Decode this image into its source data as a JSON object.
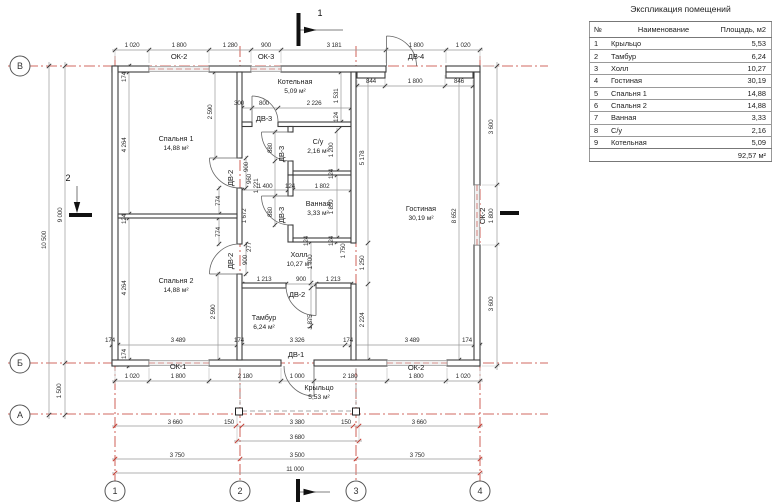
{
  "table": {
    "title": "Экспликация помещений",
    "headers": [
      "№",
      "Наименование",
      "Площадь, м2"
    ],
    "rows": [
      [
        "1",
        "Крыльцо",
        "5,53"
      ],
      [
        "2",
        "Тамбур",
        "6,24"
      ],
      [
        "3",
        "Холл",
        "10,27"
      ],
      [
        "4",
        "Гостиная",
        "30,19"
      ],
      [
        "5",
        "Спальня 1",
        "14,88"
      ],
      [
        "6",
        "Спальня 2",
        "14,88"
      ],
      [
        "7",
        "Ванная",
        "3,33"
      ],
      [
        "8",
        "С/у",
        "2,16"
      ],
      [
        "9",
        "Котельная",
        "5,09"
      ]
    ],
    "total": "92,57 м²"
  },
  "plan": {
    "rooms": [
      {
        "name": "Котельная",
        "area": "5,09 м²",
        "x": 295,
        "y": 84
      },
      {
        "name": "С/у",
        "area": "2,16 м²",
        "x": 318,
        "y": 144
      },
      {
        "name": "Ванная",
        "area": "3,33 м²",
        "x": 318,
        "y": 206
      },
      {
        "name": "Спальня 1",
        "area": "14,88 м²",
        "x": 176,
        "y": 141
      },
      {
        "name": "Спальня 2",
        "area": "14,88 м²",
        "x": 176,
        "y": 283
      },
      {
        "name": "Холл",
        "area": "10,27 м²",
        "x": 299,
        "y": 257
      },
      {
        "name": "Тамбур",
        "area": "6,24 м²",
        "x": 264,
        "y": 320
      },
      {
        "name": "Гостиная",
        "area": "30,19 м²",
        "x": 421,
        "y": 211
      },
      {
        "name": "Крыльцо",
        "area": "5,53 м²",
        "x": 319,
        "y": 390
      }
    ],
    "openings": [
      [
        "ОК-2",
        179,
        59,
        0
      ],
      [
        "ОК-3",
        266,
        59,
        0
      ],
      [
        "ДВ-4",
        416,
        59,
        0
      ],
      [
        "ДВ-3",
        264,
        121,
        0
      ],
      [
        "ДВ-3",
        284,
        154,
        1
      ],
      [
        "ДВ-3",
        284,
        215,
        1
      ],
      [
        "ДВ-2",
        233,
        178,
        1
      ],
      [
        "ДВ-2",
        233,
        261,
        1
      ],
      [
        "ДВ-2",
        297,
        297,
        0
      ],
      [
        "ДВ-1",
        296,
        357,
        0
      ],
      [
        "ОК-1",
        178,
        369,
        0
      ],
      [
        "ОК-2",
        416,
        370,
        0
      ],
      [
        "ОК-2",
        485,
        216,
        1
      ]
    ],
    "dims": [
      [
        "1 020",
        132,
        47,
        0
      ],
      [
        "1 800",
        179,
        47,
        0
      ],
      [
        "1 280",
        230,
        47,
        0
      ],
      [
        "900",
        266,
        47,
        0
      ],
      [
        "3 181",
        334,
        47,
        0
      ],
      [
        "1 800",
        416,
        47,
        0
      ],
      [
        "1 020",
        463,
        47,
        0
      ],
      [
        "844",
        371,
        83,
        0
      ],
      [
        "1 800",
        415,
        83,
        0
      ],
      [
        "846",
        459,
        83,
        0
      ],
      [
        "300",
        239,
        105,
        0
      ],
      [
        "800",
        264,
        105,
        0
      ],
      [
        "2 226",
        314,
        105,
        0
      ],
      [
        "1 400",
        265,
        188,
        0
      ],
      [
        "124",
        290,
        188,
        0
      ],
      [
        "1 802",
        322,
        188,
        0
      ],
      [
        "1 213",
        264,
        281,
        0
      ],
      [
        "900",
        301,
        281,
        0
      ],
      [
        "1 213",
        333,
        281,
        0
      ],
      [
        "174",
        110,
        342,
        0
      ],
      [
        "3 489",
        178,
        342,
        0
      ],
      [
        "174",
        239,
        342,
        0
      ],
      [
        "3 326",
        297,
        342,
        0
      ],
      [
        "174",
        348,
        342,
        0
      ],
      [
        "3 489",
        412,
        342,
        0
      ],
      [
        "174",
        467,
        342,
        0
      ],
      [
        "1 020",
        132,
        378,
        0
      ],
      [
        "1 800",
        178,
        378,
        0
      ],
      [
        "2 180",
        245,
        378,
        0
      ],
      [
        "1 000",
        297,
        378,
        0
      ],
      [
        "2 180",
        350,
        378,
        0
      ],
      [
        "1 800",
        416,
        378,
        0
      ],
      [
        "1 020",
        463,
        378,
        0
      ],
      [
        "3 660",
        175,
        424,
        0
      ],
      [
        "150",
        229,
        424,
        0
      ],
      [
        "3 380",
        297,
        424,
        0
      ],
      [
        "150",
        346,
        424,
        0
      ],
      [
        "3 660",
        419,
        424,
        0
      ],
      [
        "3 680",
        297,
        439,
        0
      ],
      [
        "3 750",
        177,
        457,
        0
      ],
      [
        "3 500",
        297,
        457,
        0
      ],
      [
        "3 750",
        417,
        457,
        0
      ],
      [
        "11 000",
        295,
        471,
        0
      ],
      [
        "9 000",
        62,
        215,
        1
      ],
      [
        "10 500",
        46,
        240,
        1
      ],
      [
        "1 500",
        61,
        391,
        1
      ],
      [
        "174",
        126,
        77,
        1
      ],
      [
        "4 264",
        126,
        145,
        1
      ],
      [
        "124",
        126,
        219,
        1
      ],
      [
        "4 264",
        126,
        288,
        1
      ],
      [
        "174",
        126,
        354,
        1
      ],
      [
        "2 590",
        212,
        112,
        1
      ],
      [
        "1 531",
        338,
        96,
        1
      ],
      [
        "124",
        338,
        117,
        1
      ],
      [
        "1 200",
        333,
        150,
        1
      ],
      [
        "124",
        333,
        174,
        1
      ],
      [
        "1 850",
        333,
        207,
        1
      ],
      [
        "124",
        333,
        241,
        1
      ],
      [
        "880",
        272,
        148,
        1
      ],
      [
        "880",
        272,
        212,
        1
      ],
      [
        "900",
        248,
        167,
        1
      ],
      [
        "960",
        251,
        179,
        1
      ],
      [
        "1 221",
        258,
        186,
        1
      ],
      [
        "1 672",
        246,
        216,
        1
      ],
      [
        "774",
        220,
        201,
        1
      ],
      [
        "774",
        220,
        232,
        1
      ],
      [
        "900",
        247,
        260,
        1
      ],
      [
        "277",
        251,
        247,
        1
      ],
      [
        "124",
        308,
        241,
        1
      ],
      [
        "1 700",
        312,
        262,
        1
      ],
      [
        "1 750",
        345,
        251,
        1
      ],
      [
        "1 875",
        312,
        322,
        1
      ],
      [
        "2 590",
        215,
        312,
        1
      ],
      [
        "5 178",
        364,
        158,
        1
      ],
      [
        "1 250",
        364,
        263,
        1
      ],
      [
        "2 224",
        364,
        320,
        1
      ],
      [
        "8 652",
        456,
        216,
        1
      ],
      [
        "3 600",
        493,
        127,
        1
      ],
      [
        "1 800",
        493,
        216,
        1
      ],
      [
        "3 600",
        493,
        304,
        1
      ]
    ],
    "axis_rows": [
      {
        "t": "В",
        "x": 20,
        "y": 66
      },
      {
        "t": "Б",
        "x": 20,
        "y": 363
      },
      {
        "t": "А",
        "x": 20,
        "y": 415
      }
    ],
    "axis_cols": [
      {
        "t": "1",
        "x": 115,
        "y": 491
      },
      {
        "t": "2",
        "x": 240,
        "y": 491
      },
      {
        "t": "3",
        "x": 356,
        "y": 491
      },
      {
        "t": "4",
        "x": 480,
        "y": 491
      }
    ],
    "section_labels": [
      {
        "t": "1",
        "x": 320,
        "y": 16
      },
      {
        "t": "2",
        "x": 68,
        "y": 181
      }
    ]
  },
  "colors": {
    "axis_red": "#c43a2f",
    "wall": "#3c3c3c",
    "dim_line": "#999999",
    "text": "#2e2e2e"
  }
}
